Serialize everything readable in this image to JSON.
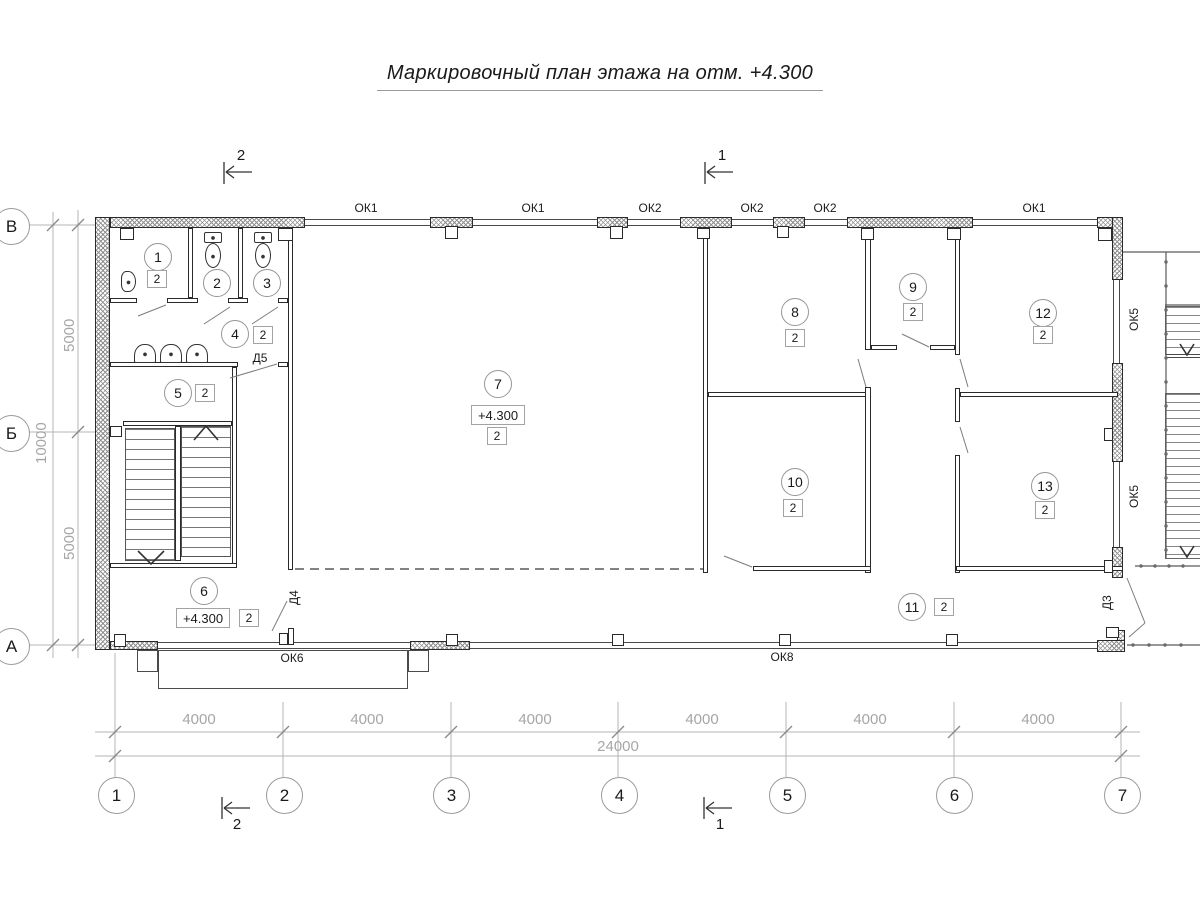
{
  "title": "Маркировочный план этажа на отм. +4.300",
  "rooms": [
    {
      "number": "1",
      "type": "2"
    },
    {
      "number": "2"
    },
    {
      "number": "3"
    },
    {
      "number": "4",
      "type": "2"
    },
    {
      "number": "5",
      "type": "2"
    },
    {
      "number": "6",
      "type": "2",
      "elevation": "+4.300"
    },
    {
      "number": "7",
      "type": "2",
      "elevation": "+4.300"
    },
    {
      "number": "8",
      "type": "2"
    },
    {
      "number": "9",
      "type": "2"
    },
    {
      "number": "10",
      "type": "2"
    },
    {
      "number": "11",
      "type": "2"
    },
    {
      "number": "12",
      "type": "2"
    },
    {
      "number": "13",
      "type": "2"
    }
  ],
  "windows": {
    "top": [
      "ОК1",
      "ОК1",
      "ОК2",
      "ОК2",
      "ОК2",
      "ОК1"
    ],
    "bottom": [
      "ОК6",
      "ОК8"
    ],
    "right": [
      "ОК5",
      "ОК5"
    ]
  },
  "doors": [
    "Д5",
    "Д4",
    "Д3"
  ],
  "axes": {
    "horizontal": [
      "1",
      "2",
      "3",
      "4",
      "5",
      "6",
      "7"
    ],
    "vertical": [
      "В",
      "Б",
      "А"
    ]
  },
  "dimensions": {
    "bottom_segments": [
      "4000",
      "4000",
      "4000",
      "4000",
      "4000",
      "4000"
    ],
    "bottom_total": "24000",
    "left_segments": [
      "5000",
      "5000"
    ],
    "left_total": "10000"
  },
  "section_marks": {
    "top_left": "2",
    "top_right": "1",
    "bottom_left": "2",
    "bottom_right": "1"
  }
}
